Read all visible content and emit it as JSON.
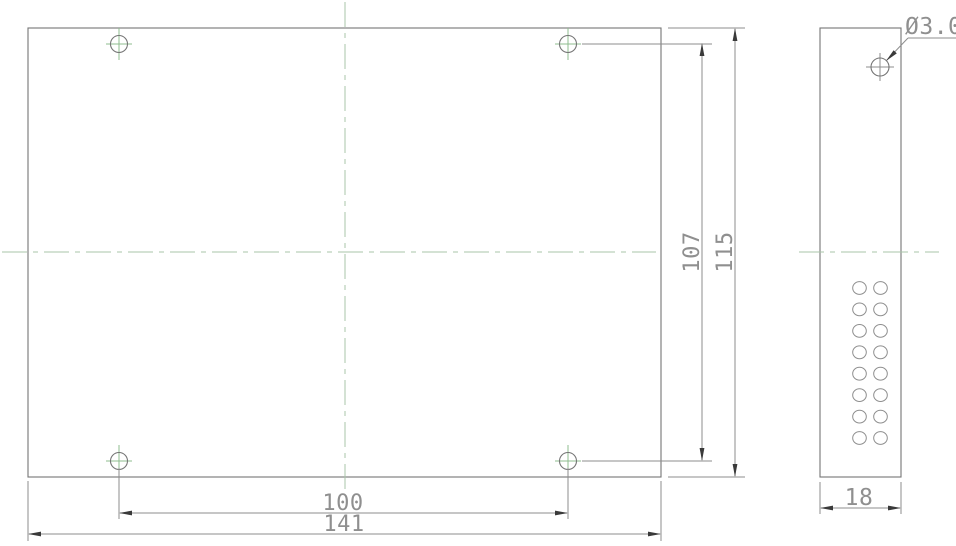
{
  "drawing": {
    "type": "technical-dimension-drawing",
    "views": {
      "front_view": {
        "name": "front-panel-view",
        "mounting_holes": 4
      },
      "side_view": {
        "name": "side-panel-view",
        "vent_holes": 16,
        "vent_grid": "2x8"
      }
    },
    "dimensions": {
      "hole_spacing_vertical": "107",
      "overall_height": "115",
      "hole_spacing_horizontal": "100",
      "overall_width": "141",
      "side_depth": "18",
      "hole_diameter": "Ø3.0"
    },
    "colors": {
      "background": "#ffffff",
      "object_line": "#757575",
      "dimension_line": "#8e8e8e",
      "dimension_text": "#8f8f8f",
      "centerline_green": "#a9c4a9",
      "hole_mark_green": "#8fbc8f",
      "arrow": "#3a3a3a"
    }
  }
}
